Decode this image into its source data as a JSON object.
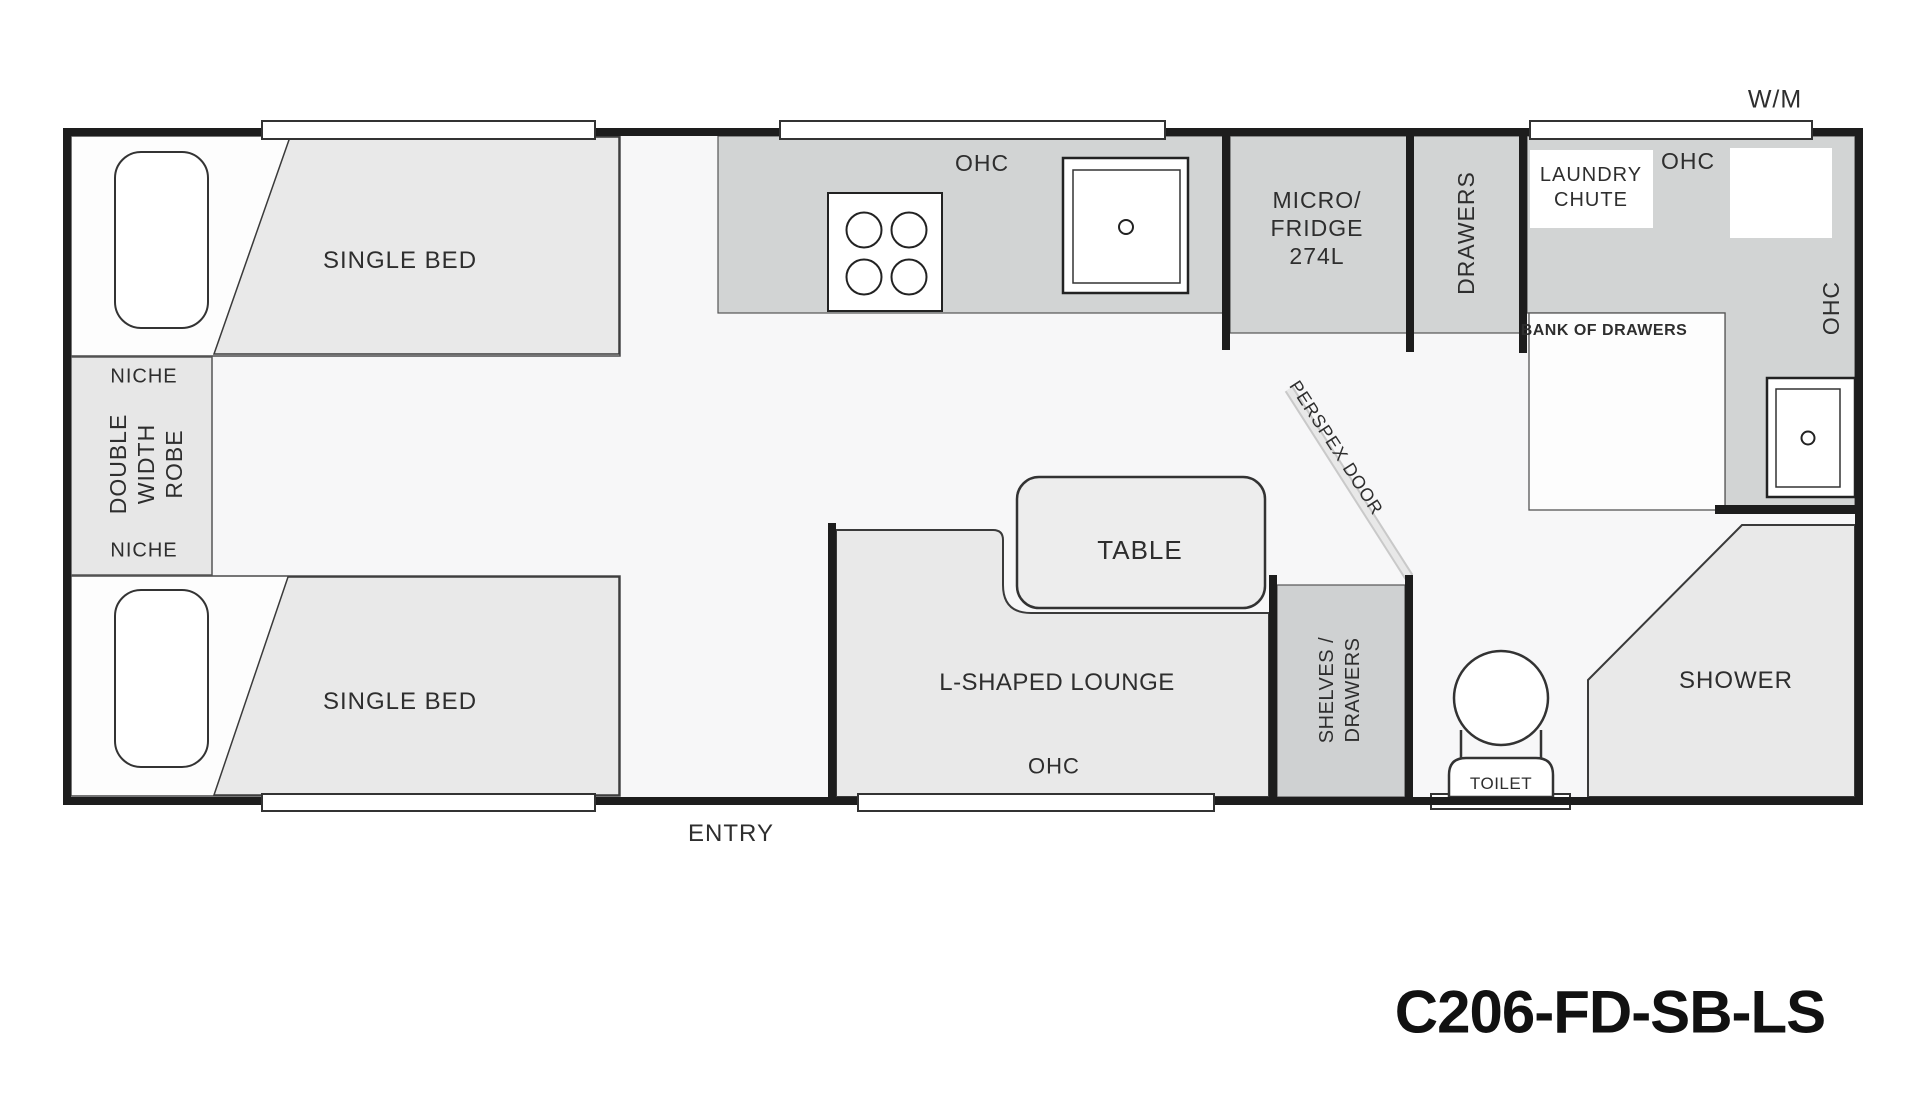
{
  "model_label": "C206-FD-SB-LS",
  "exterior": {
    "wm": "W/M",
    "entry": "ENTRY"
  },
  "front_bedroom": {
    "bed_top": "SINGLE BED",
    "bed_bottom": "SINGLE BED",
    "niche_top": "NICHE",
    "niche_bottom": "NICHE",
    "robe_lines": [
      "DOUBLE",
      "WIDTH",
      "ROBE"
    ]
  },
  "kitchen": {
    "ohc": "OHC",
    "micro_fridge_lines": [
      "MICRO/",
      "FRIDGE",
      "274L"
    ],
    "drawers": "DRAWERS"
  },
  "living": {
    "table": "TABLE",
    "lounge": "L-SHAPED LOUNGE",
    "ohc": "OHC",
    "shelves_lines": [
      "SHELVES /",
      "DRAWERS"
    ]
  },
  "bathroom": {
    "laundry_chute_lines": [
      "LAUNDRY",
      "CHUTE"
    ],
    "ohc_top": "OHC",
    "ohc_side": "OHC",
    "bank_of_drawers": "BANK OF DRAWERS",
    "perspex_door": "PERSPEX DOOR",
    "toilet": "TOILET",
    "shower": "SHOWER"
  },
  "colors": {
    "wall": "#1d1d1d",
    "unit_gray": "#d2d4d4",
    "soft_gray": "#e9e9e9",
    "floor": "#f7f7f8",
    "white": "#ffffff",
    "text": "#2e2e2e",
    "perspex": "#d6d6d6"
  }
}
